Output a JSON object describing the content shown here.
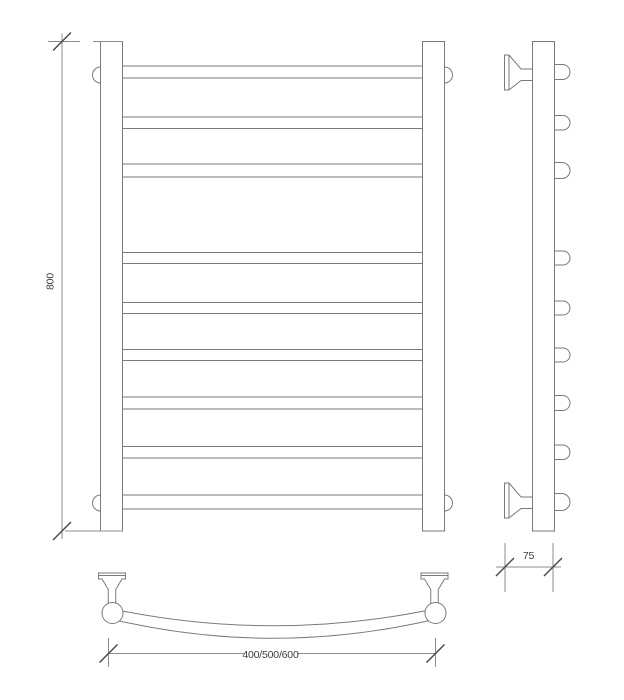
{
  "drawing": {
    "type": "technical-drawing-towel-rail",
    "colors": {
      "background": "#ffffff",
      "outline": "#7a7a7a",
      "dimension_line": "#8c8c8c",
      "tick": "#4a4a4a",
      "text": "#3c3c3c"
    },
    "dims": {
      "height": "800",
      "depth": "75",
      "width_options": "400/500/600"
    },
    "front_view": {
      "rung_count": 9,
      "rungs": [
        [
          66,
          78
        ],
        [
          117,
          128.5
        ],
        [
          164,
          177
        ],
        [
          252.5,
          263.5
        ],
        [
          302.5,
          313.5
        ],
        [
          349.5,
          360.5
        ],
        [
          397,
          409
        ],
        [
          446.5,
          458
        ],
        [
          495,
          509
        ]
      ],
      "rung_left_x": 122.5,
      "rung_width": 300
    },
    "side_view": {
      "stub_count": 9,
      "stub_left_x": 554.5,
      "stub_reach_x": 570
    }
  }
}
